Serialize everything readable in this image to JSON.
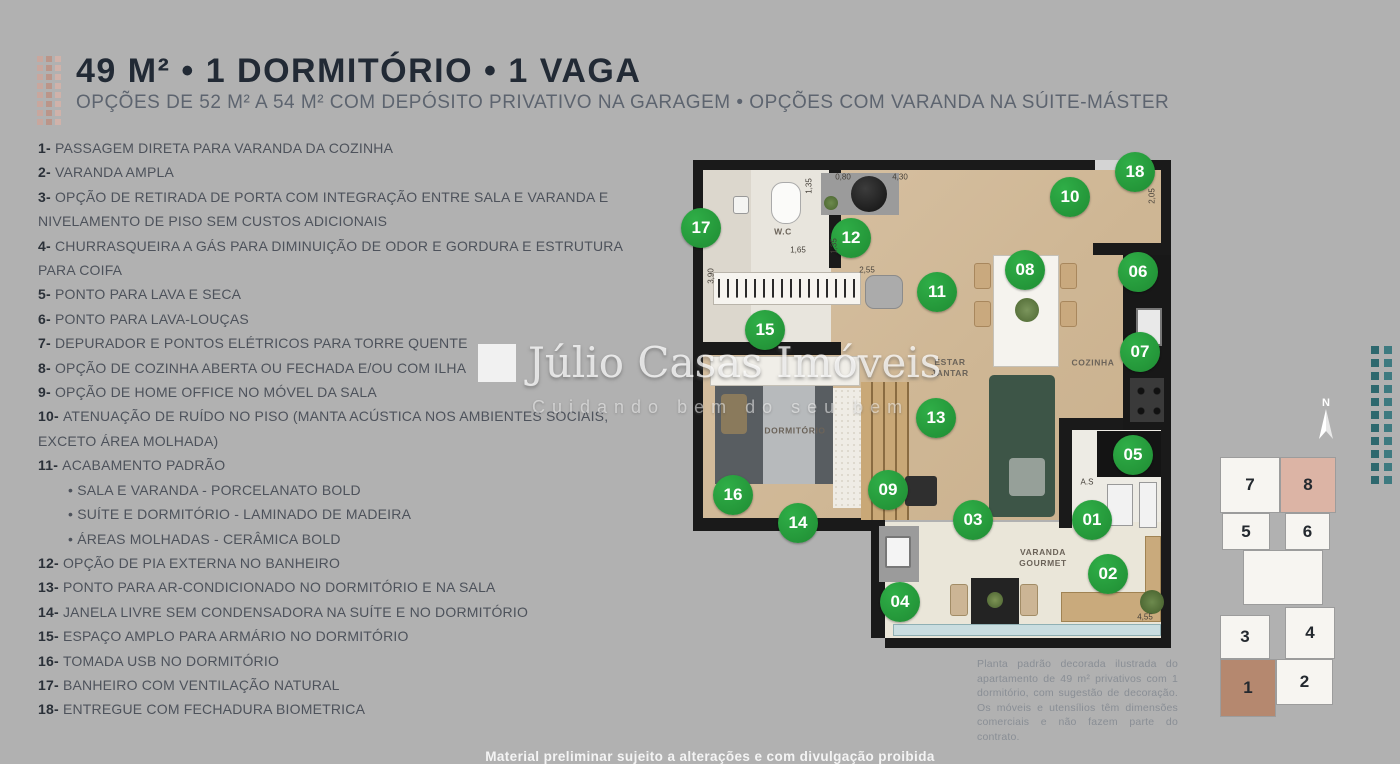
{
  "header": {
    "title": "49 M² • 1 DORMITÓRIO • 1 VAGA",
    "subtitle": "OPÇÕES DE 52 M² A 54 M² COM DEPÓSITO PRIVATIVO NA GARAGEM • OPÇÕES COM VARANDA NA SÚITE-MÁSTER"
  },
  "features": [
    {
      "n": "1",
      "text": "PASSAGEM DIRETA PARA VARANDA DA COZINHA"
    },
    {
      "n": "2",
      "text": "VARANDA AMPLA"
    },
    {
      "n": "3",
      "text": "OPÇÃO DE RETIRADA DE PORTA COM INTEGRAÇÃO ENTRE SALA E VARANDA E NIVELAMENTO DE PISO SEM CUSTOS ADICIONAIS"
    },
    {
      "n": "4",
      "text": "CHURRASQUEIRA A GÁS PARA DIMINUIÇÃO DE ODOR E GORDURA E ESTRUTURA PARA COIFA"
    },
    {
      "n": "5",
      "text": "PONTO PARA LAVA E SECA"
    },
    {
      "n": "6",
      "text": "PONTO PARA LAVA-LOUÇAS"
    },
    {
      "n": "7",
      "text": "DEPURADOR E PONTOS ELÉTRICOS PARA TORRE QUENTE"
    },
    {
      "n": "8",
      "text": "OPÇÃO DE COZINHA ABERTA OU FECHADA E/OU COM ILHA"
    },
    {
      "n": "9",
      "text": "OPÇÃO DE HOME OFFICE NO MÓVEL DA SALA"
    },
    {
      "n": "10",
      "text": "ATENUAÇÃO DE RUÍDO NO PISO (MANTA ACÚSTICA NOS AMBIENTES SOCIAIS, EXCETO ÁREA MOLHADA)"
    },
    {
      "n": "11",
      "text": "ACABAMENTO PADRÃO",
      "sub": [
        "SALA E VARANDA - PORCELANATO BOLD",
        "SUÍTE E DORMITÓRIO - LAMINADO DE MADEIRA",
        "ÁREAS MOLHADAS - CERÂMICA BOLD"
      ]
    },
    {
      "n": "12",
      "text": "OPÇÃO DE PIA EXTERNA NO BANHEIRO"
    },
    {
      "n": "13",
      "text": "PONTO PARA AR-CONDICIONADO NO DORMITÓRIO E NA SALA"
    },
    {
      "n": "14",
      "text": "JANELA LIVRE SEM CONDENSADORA NA SUÍTE E NO DORMITÓRIO"
    },
    {
      "n": "15",
      "text": "ESPAÇO AMPLO PARA ARMÁRIO NO DORMITÓRIO"
    },
    {
      "n": "16",
      "text": "TOMADA USB NO DORMITÓRIO"
    },
    {
      "n": "17",
      "text": "BANHEIRO COM VENTILAÇÃO NATURAL"
    },
    {
      "n": "18",
      "text": "ENTREGUE COM FECHADURA BIOMETRICA"
    }
  ],
  "floorplan": {
    "markers": [
      {
        "num": "01",
        "x": 399,
        "y": 360
      },
      {
        "num": "02",
        "x": 415,
        "y": 414
      },
      {
        "num": "03",
        "x": 280,
        "y": 360
      },
      {
        "num": "04",
        "x": 207,
        "y": 442
      },
      {
        "num": "05",
        "x": 440,
        "y": 295
      },
      {
        "num": "06",
        "x": 445,
        "y": 112
      },
      {
        "num": "07",
        "x": 447,
        "y": 192
      },
      {
        "num": "08",
        "x": 332,
        "y": 110
      },
      {
        "num": "09",
        "x": 195,
        "y": 330
      },
      {
        "num": "10",
        "x": 377,
        "y": 37
      },
      {
        "num": "11",
        "x": 244,
        "y": 132
      },
      {
        "num": "12",
        "x": 158,
        "y": 78
      },
      {
        "num": "13",
        "x": 243,
        "y": 258
      },
      {
        "num": "14",
        "x": 105,
        "y": 363
      },
      {
        "num": "15",
        "x": 72,
        "y": 170
      },
      {
        "num": "16",
        "x": 40,
        "y": 335
      },
      {
        "num": "17",
        "x": 8,
        "y": 68
      },
      {
        "num": "18",
        "x": 442,
        "y": 12
      }
    ],
    "room_labels": [
      {
        "text": "W.C",
        "x": 90,
        "y": 72
      },
      {
        "text": "ESTAR\nJANTAR",
        "x": 257,
        "y": 208
      },
      {
        "text": "COZINHA",
        "x": 400,
        "y": 203
      },
      {
        "text": "DORMITÓRIO",
        "x": 102,
        "y": 271
      },
      {
        "text": "VARANDA\nGOURMET",
        "x": 350,
        "y": 398
      }
    ],
    "measurements": [
      {
        "t": "1,35",
        "x": 116,
        "y": 26,
        "rot": true
      },
      {
        "t": "0,80",
        "x": 150,
        "y": 17,
        "rot": false
      },
      {
        "t": "4,30",
        "x": 207,
        "y": 17,
        "rot": false
      },
      {
        "t": "1,65",
        "x": 105,
        "y": 90,
        "rot": false
      },
      {
        "t": "1,35",
        "x": 141,
        "y": 86,
        "rot": true
      },
      {
        "t": "2,05",
        "x": 459,
        "y": 36,
        "rot": true
      },
      {
        "t": "3,90",
        "x": 18,
        "y": 116,
        "rot": true
      },
      {
        "t": "2,55",
        "x": 174,
        "y": 110,
        "rot": false
      },
      {
        "t": "A.S",
        "x": 394,
        "y": 322,
        "rot": false
      },
      {
        "t": "4,55",
        "x": 452,
        "y": 457,
        "rot": false
      }
    ]
  },
  "watermark": {
    "brand": "Júlio Casas Imóveis",
    "tagline": "Cuidando bem do seu bem"
  },
  "keyplan": {
    "north_label": "N",
    "units": [
      {
        "num": "7",
        "x": 7,
        "y": 64,
        "w": 60,
        "h": 56,
        "hl": ""
      },
      {
        "num": "8",
        "x": 67,
        "y": 64,
        "w": 56,
        "h": 56,
        "hl": "light"
      },
      {
        "num": "5",
        "x": 9,
        "y": 120,
        "w": 48,
        "h": 37,
        "hl": ""
      },
      {
        "num": "6",
        "x": 72,
        "y": 120,
        "w": 45,
        "h": 37,
        "hl": ""
      },
      {
        "num": "",
        "x": 30,
        "y": 157,
        "w": 80,
        "h": 55,
        "hl": ""
      },
      {
        "num": "3",
        "x": 7,
        "y": 222,
        "w": 50,
        "h": 44,
        "hl": ""
      },
      {
        "num": "4",
        "x": 72,
        "y": 214,
        "w": 50,
        "h": 52,
        "hl": ""
      },
      {
        "num": "1",
        "x": 7,
        "y": 266,
        "w": 56,
        "h": 58,
        "hl": "dark"
      },
      {
        "num": "2",
        "x": 63,
        "y": 266,
        "w": 57,
        "h": 46,
        "hl": ""
      }
    ]
  },
  "disclaimer": "Planta padrão decorada ilustrada do apartamento de 49 m² privativos com 1 dormitório, com sugestão de decoração. Os móveis e utensílios têm dimensões comerciais e não fazem parte do contrato.",
  "footer": "Material preliminar sujeito a alterações e com divulgação proibida",
  "colors": {
    "background": "#b1b1b1",
    "title": "#222a35",
    "marker_green": "#27a13d",
    "unit1_highlight": "#b5886f",
    "unit8_highlight": "#dcb4a5",
    "salmon_dots": [
      "#c8a79e",
      "#bb9589",
      "#d0b2aa"
    ],
    "teal_dots": [
      "#2d686e",
      "#3d7a80"
    ],
    "wood_floor": "#d3bc9c",
    "wall": "#1a1a1a"
  },
  "dot_grids": {
    "salmon": {
      "cols": 3,
      "rows": 8
    },
    "teal": {
      "cols": 2,
      "rows": 11
    }
  }
}
